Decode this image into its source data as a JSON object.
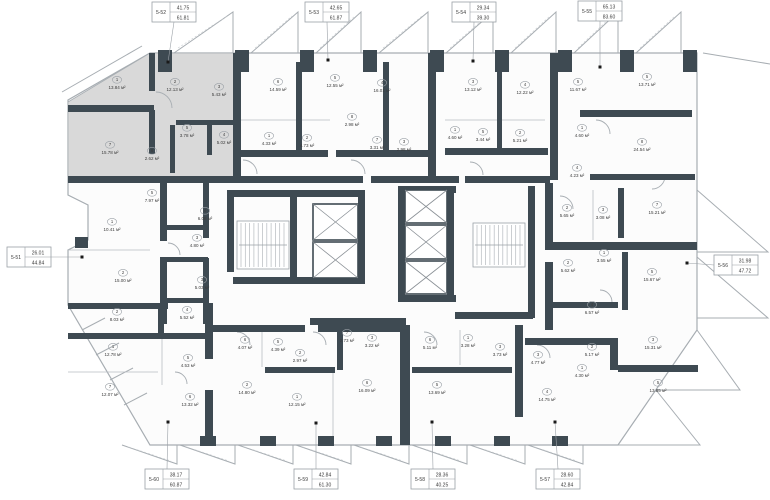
{
  "colors": {
    "wall": "#3E4A52",
    "highlight": "#D9D9D9",
    "floor": "#FCFCFC",
    "line": "#A7ADB2",
    "text": "#3C3C3C",
    "leader": "#9AA0A6",
    "dot": "#1A1A1A"
  },
  "callouts": [
    {
      "id": "5-52",
      "v1": "41.75",
      "v2": "61.81",
      "bx": 174,
      "by": 12,
      "side": "top",
      "dx": 168,
      "dy": 62
    },
    {
      "id": "5-53",
      "v1": "42.65",
      "v2": "61.87",
      "bx": 327,
      "by": 12,
      "side": "top",
      "dx": 328,
      "dy": 60
    },
    {
      "id": "5-54",
      "v1": "29.34",
      "v2": "39.30",
      "bx": 474,
      "by": 12,
      "side": "top",
      "dx": 473,
      "dy": 61
    },
    {
      "id": "5-55",
      "v1": "65.13",
      "v2": "83.60",
      "bx": 600,
      "by": 11,
      "side": "top",
      "dx": 600,
      "dy": 67
    },
    {
      "id": "5-51",
      "v1": "26.01",
      "v2": "44.84",
      "bx": 29,
      "by": 257,
      "side": "left",
      "dx": 82,
      "dy": 257
    },
    {
      "id": "5-56",
      "v1": "31.98",
      "v2": "47.72",
      "bx": 736,
      "by": 265,
      "side": "right",
      "dx": 687,
      "dy": 263
    },
    {
      "id": "5-60",
      "v1": "38.17",
      "v2": "60.87",
      "bx": 167,
      "by": 479,
      "side": "bottom",
      "dx": 168,
      "dy": 422
    },
    {
      "id": "5-59",
      "v1": "42.84",
      "v2": "61.30",
      "bx": 316,
      "by": 479,
      "side": "bottom",
      "dx": 316,
      "dy": 423
    },
    {
      "id": "5-58",
      "v1": "28.36",
      "v2": "40.25",
      "bx": 433,
      "by": 479,
      "side": "bottom",
      "dx": 432,
      "dy": 422
    },
    {
      "id": "5-57",
      "v1": "28.60",
      "v2": "42.84",
      "bx": 558,
      "by": 479,
      "side": "bottom",
      "dx": 555,
      "dy": 422
    }
  ],
  "rooms": [
    {
      "n": "1",
      "a": "13.84 м²",
      "x": 117,
      "y": 83,
      "h": 1
    },
    {
      "n": "2",
      "a": "12.13 м²",
      "x": 175,
      "y": 85,
      "h": 1
    },
    {
      "n": "3",
      "a": "5.43 м²",
      "x": 219,
      "y": 90,
      "h": 1
    },
    {
      "n": "5",
      "a": "3.78 м²",
      "x": 187,
      "y": 131,
      "h": 1
    },
    {
      "n": "4",
      "a": "5.02 м²",
      "x": 224,
      "y": 138,
      "h": 1
    },
    {
      "n": "6",
      "a": "2.62 м²",
      "x": 152,
      "y": 154,
      "h": 1
    },
    {
      "n": "7",
      "a": "15.78 м²",
      "x": 110,
      "y": 148,
      "h": 1
    },
    {
      "n": "6",
      "a": "14.59 м²",
      "x": 278,
      "y": 85,
      "h": 0
    },
    {
      "n": "5",
      "a": "12.55 м²",
      "x": 335,
      "y": 81,
      "h": 0
    },
    {
      "n": "4",
      "a": "16.01 м²",
      "x": 382,
      "y": 86,
      "h": 0
    },
    {
      "n": "8",
      "a": "2.98 м²",
      "x": 352,
      "y": 120,
      "h": 0
    },
    {
      "n": "1",
      "a": "4.33 м²",
      "x": 269,
      "y": 139,
      "h": 0
    },
    {
      "n": "2",
      "a": "4.73 м²",
      "x": 307,
      "y": 141,
      "h": 0
    },
    {
      "n": "7",
      "a": "3.31 м²",
      "x": 377,
      "y": 143,
      "h": 0
    },
    {
      "n": "3",
      "a": "2.98 м²",
      "x": 404,
      "y": 145,
      "h": 0
    },
    {
      "n": "3",
      "a": "13.12 м²",
      "x": 473,
      "y": 85,
      "h": 0
    },
    {
      "n": "4",
      "a": "12.22 м²",
      "x": 525,
      "y": 88,
      "h": 0
    },
    {
      "n": "5",
      "a": "11.67 м²",
      "x": 578,
      "y": 85,
      "h": 0
    },
    {
      "n": "1",
      "a": "4.60 м²",
      "x": 455,
      "y": 133,
      "h": 0
    },
    {
      "n": "5",
      "a": "3.44 м²",
      "x": 483,
      "y": 135,
      "h": 0
    },
    {
      "n": "2",
      "a": "5.21 м²",
      "x": 520,
      "y": 136,
      "h": 0
    },
    {
      "n": "1",
      "a": "4.60 м²",
      "x": 582,
      "y": 131,
      "h": 0
    },
    {
      "n": "4",
      "a": "4.23 м²",
      "x": 577,
      "y": 171,
      "h": 0
    },
    {
      "n": "5",
      "a": "13.71 м²",
      "x": 647,
      "y": 80,
      "h": 0
    },
    {
      "n": "8",
      "a": "24.54 м²",
      "x": 642,
      "y": 145,
      "h": 0
    },
    {
      "n": "7",
      "a": "15.21 м²",
      "x": 657,
      "y": 208,
      "h": 0
    },
    {
      "n": "3",
      "a": "3.08 м²",
      "x": 603,
      "y": 213,
      "h": 0
    },
    {
      "n": "2",
      "a": "5.65 м²",
      "x": 567,
      "y": 211,
      "h": 0
    },
    {
      "n": "2",
      "a": "5.62 м²",
      "x": 568,
      "y": 266,
      "h": 0
    },
    {
      "n": "1",
      "a": "3.55 м²",
      "x": 604,
      "y": 256,
      "h": 0
    },
    {
      "n": "5",
      "a": "15.67 м²",
      "x": 652,
      "y": 275,
      "h": 0
    },
    {
      "n": "5",
      "a": "7.97 м²",
      "x": 152,
      "y": 196,
      "h": 0
    },
    {
      "n": "1",
      "a": "10.41 м²",
      "x": 112,
      "y": 225,
      "h": 0
    },
    {
      "n": "4",
      "a": "6.08 м²",
      "x": 205,
      "y": 214,
      "h": 0
    },
    {
      "n": "3",
      "a": "4.80 м²",
      "x": 197,
      "y": 241,
      "h": 0
    },
    {
      "n": "2",
      "a": "15.00 м²",
      "x": 123,
      "y": 276,
      "h": 0
    },
    {
      "n": "3",
      "a": "5.03 м²",
      "x": 202,
      "y": 283,
      "h": 0
    },
    {
      "n": "2",
      "a": "8.03 м²",
      "x": 117,
      "y": 315,
      "h": 0
    },
    {
      "n": "4",
      "a": "5.52 м²",
      "x": 187,
      "y": 313,
      "h": 0
    },
    {
      "n": "1",
      "a": "12.78 м²",
      "x": 113,
      "y": 350,
      "h": 0
    },
    {
      "n": "5",
      "a": "4.53 м²",
      "x": 188,
      "y": 361,
      "h": 0
    },
    {
      "n": "6",
      "a": "4.07 м²",
      "x": 245,
      "y": 343,
      "h": 0
    },
    {
      "n": "7",
      "a": "12.07 м²",
      "x": 110,
      "y": 390,
      "h": 0
    },
    {
      "n": "6",
      "a": "13.32 м²",
      "x": 190,
      "y": 400,
      "h": 0
    },
    {
      "n": "2",
      "a": "14.80 м²",
      "x": 247,
      "y": 388,
      "h": 0
    },
    {
      "n": "5",
      "a": "4.39 м²",
      "x": 278,
      "y": 345,
      "h": 0
    },
    {
      "n": "2",
      "a": "2.97 м²",
      "x": 300,
      "y": 356,
      "h": 0
    },
    {
      "n": "7",
      "a": "2.73 м²",
      "x": 347,
      "y": 336,
      "h": 0
    },
    {
      "n": "3",
      "a": "3.22 м²",
      "x": 372,
      "y": 341,
      "h": 0
    },
    {
      "n": "1",
      "a": "12.15 м²",
      "x": 297,
      "y": 400,
      "h": 0
    },
    {
      "n": "6",
      "a": "16.09 м²",
      "x": 367,
      "y": 386,
      "h": 0
    },
    {
      "n": "6",
      "a": "5.11 м²",
      "x": 430,
      "y": 343,
      "h": 0
    },
    {
      "n": "1",
      "a": "3.28 м²",
      "x": 468,
      "y": 341,
      "h": 0
    },
    {
      "n": "5",
      "a": "13.69 м²",
      "x": 437,
      "y": 388,
      "h": 0
    },
    {
      "n": "4",
      "a": "6.57 м²",
      "x": 592,
      "y": 308,
      "h": 0
    },
    {
      "n": "3",
      "a": "3.73 м²",
      "x": 500,
      "y": 350,
      "h": 0
    },
    {
      "n": "3",
      "a": "4.77 м²",
      "x": 538,
      "y": 358,
      "h": 0
    },
    {
      "n": "2",
      "a": "5.17 м²",
      "x": 592,
      "y": 350,
      "h": 0
    },
    {
      "n": "1",
      "a": "4.30 м²",
      "x": 582,
      "y": 371,
      "h": 0
    },
    {
      "n": "3",
      "a": "15.31 м²",
      "x": 653,
      "y": 343,
      "h": 0
    },
    {
      "n": "4",
      "a": "14.75 м²",
      "x": 547,
      "y": 395,
      "h": 0
    },
    {
      "n": "5",
      "a": "13.85 м²",
      "x": 658,
      "y": 386,
      "h": 0
    }
  ]
}
